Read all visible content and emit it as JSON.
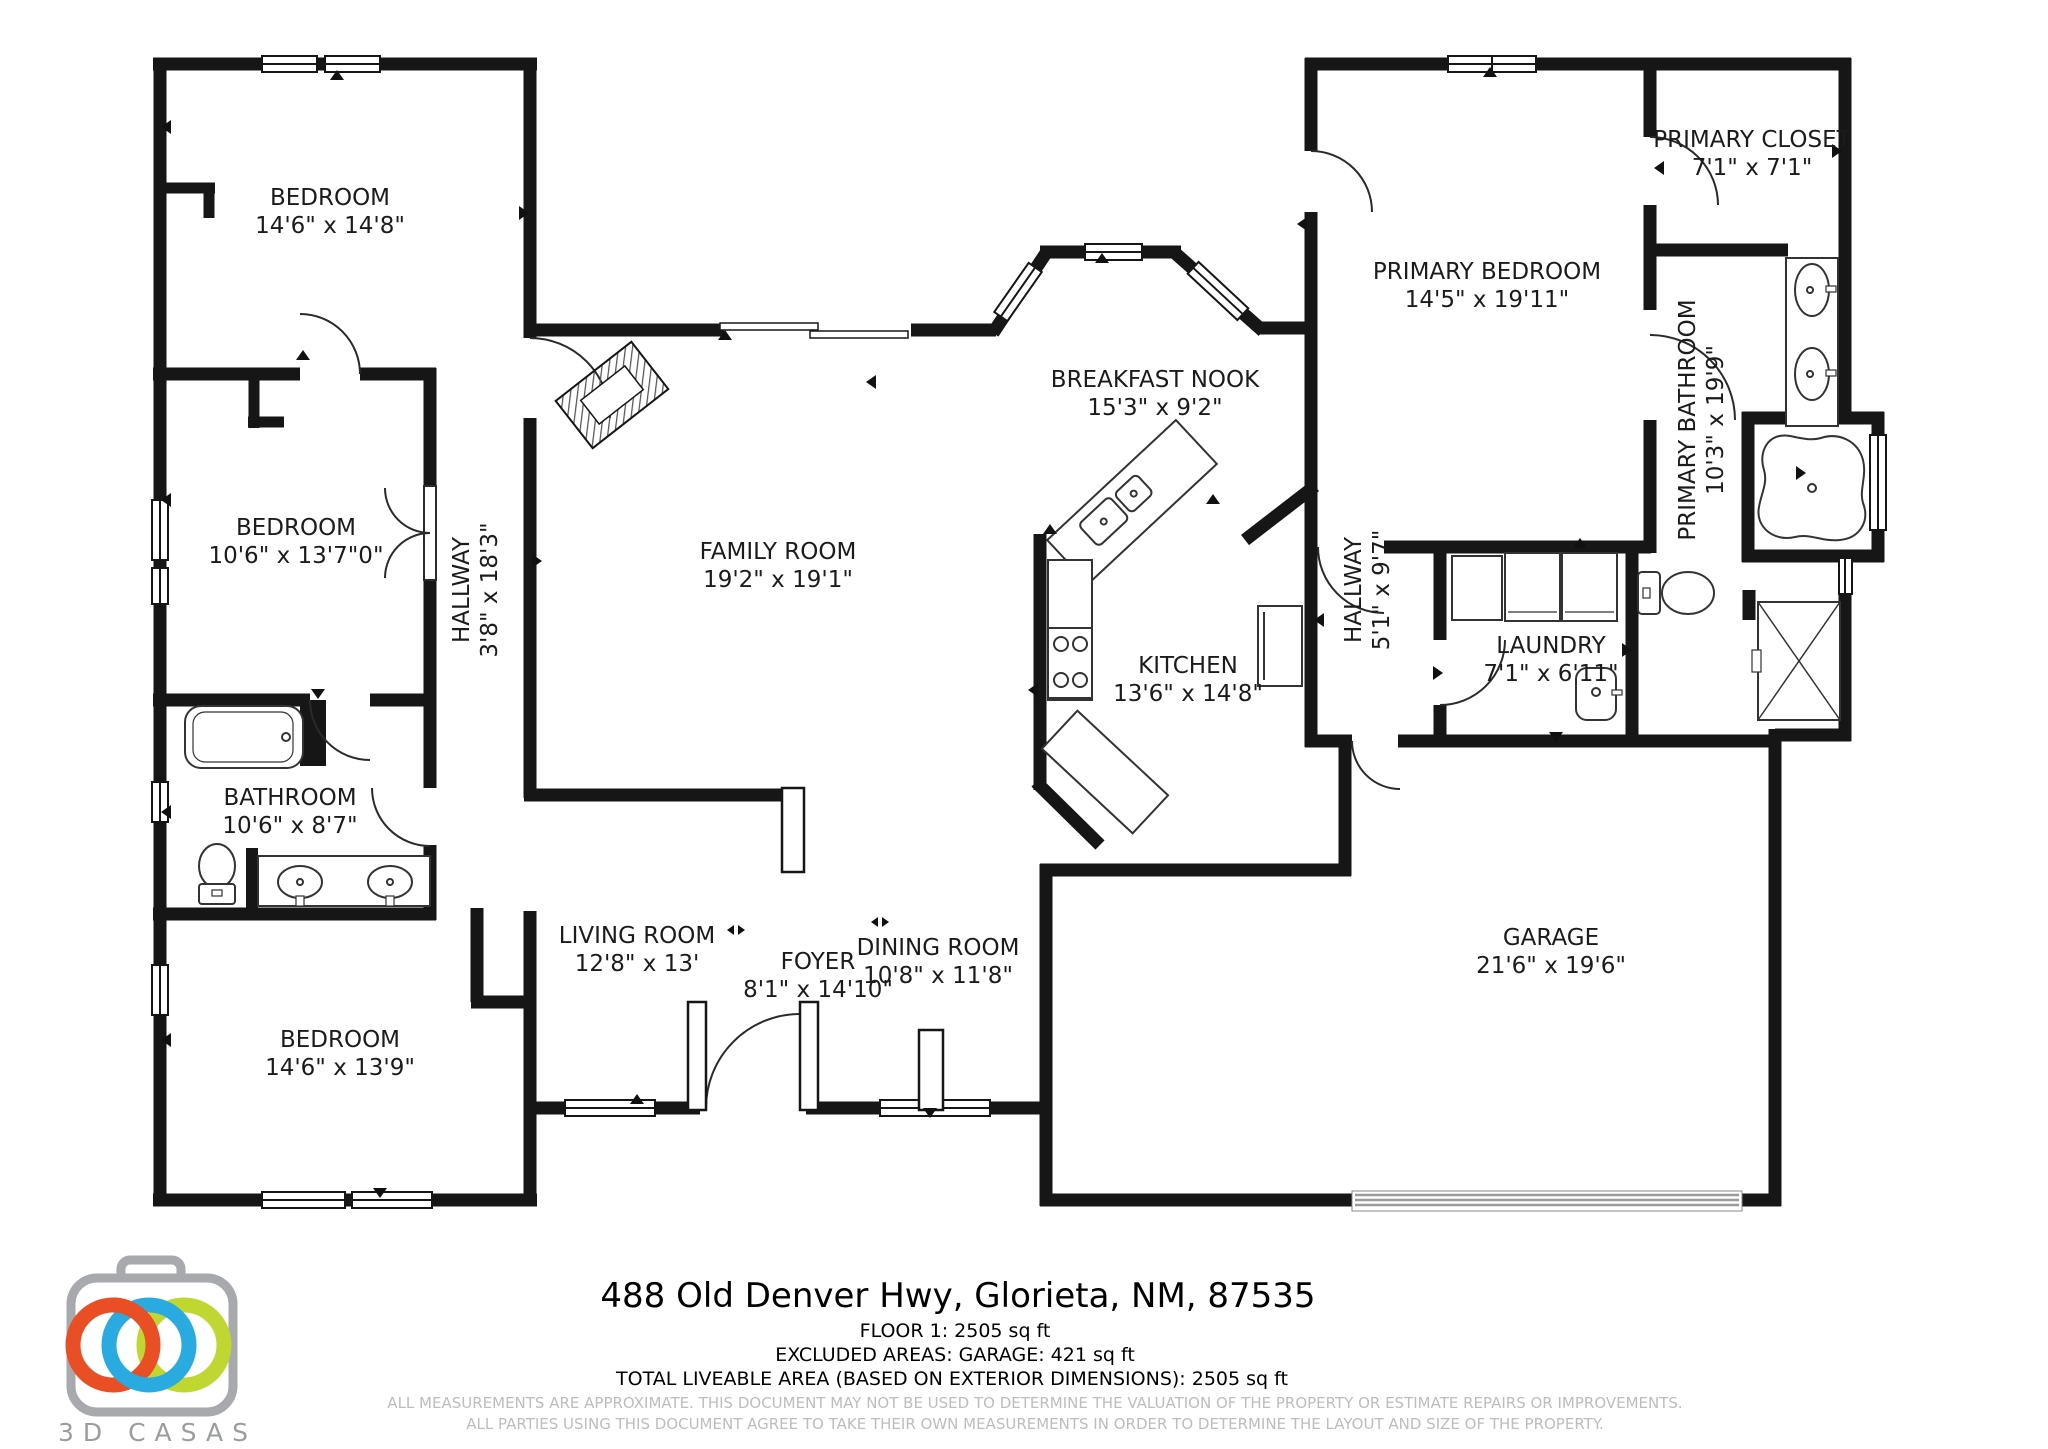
{
  "address": "488 Old Denver Hwy, Glorieta, NM, 87535",
  "floor_summary": {
    "floor_line": "FLOOR 1: 2505 sq ft",
    "excluded_line": "EXCLUDED AREAS: GARAGE: 421 sq ft",
    "total_line": "TOTAL LIVEABLE AREA (BASED ON EXTERIOR DIMENSIONS): 2505 sq ft"
  },
  "disclaimer": {
    "line1": "ALL MEASUREMENTS ARE APPROXIMATE. THIS DOCUMENT MAY NOT BE USED TO DETERMINE THE VALUATION OF THE PROPERTY OR ESTIMATE REPAIRS OR IMPROVEMENTS.",
    "line2": "ALL PARTIES USING THIS DOCUMENT AGREE TO TAKE THEIR OWN MEASUREMENTS IN ORDER TO DETERMINE THE LAYOUT AND SIZE OF THE PROPERTY."
  },
  "logo": {
    "brand": "3D CASAS",
    "orange": "#E94E24",
    "blue": "#29ABE2",
    "green": "#BFD730",
    "gray": "#A7A9AC"
  },
  "rooms": [
    {
      "id": "bedroom-1",
      "label": "BEDROOM",
      "dims": "14'6\" x 14'8\"",
      "cx": 330,
      "cy": 212,
      "rotate": 0
    },
    {
      "id": "bedroom-2",
      "label": "BEDROOM",
      "dims": "10'6\" x 13'7\"0\"",
      "cx": 296,
      "cy": 542,
      "rotate": 0
    },
    {
      "id": "hallway-main",
      "label": "HALLWAY",
      "dims": "3'8\" x 18'3\"",
      "cx": 476,
      "cy": 590,
      "rotate": -90
    },
    {
      "id": "bathroom",
      "label": "BATHROOM",
      "dims": "10'6\" x 8'7\"",
      "cx": 290,
      "cy": 812,
      "rotate": 0
    },
    {
      "id": "bedroom-3",
      "label": "BEDROOM",
      "dims": "14'6\" x 13'9\"",
      "cx": 340,
      "cy": 1054,
      "rotate": 0
    },
    {
      "id": "family-room",
      "label": "FAMILY ROOM",
      "dims": "19'2\" x 19'1\"",
      "cx": 778,
      "cy": 566,
      "rotate": 0
    },
    {
      "id": "living-room",
      "label": "LIVING ROOM",
      "dims": "12'8\" x 13'",
      "cx": 637,
      "cy": 950,
      "rotate": 0
    },
    {
      "id": "foyer",
      "label": "FOYER",
      "dims": "8'1\" x 14'10\"",
      "cx": 818,
      "cy": 976,
      "rotate": 0
    },
    {
      "id": "dining-room",
      "label": "DINING ROOM",
      "dims": "10'8\" x 11'8\"",
      "cx": 938,
      "cy": 962,
      "rotate": 0
    },
    {
      "id": "breakfast-nook",
      "label": "BREAKFAST NOOK",
      "dims": "15'3\" x 9'2\"",
      "cx": 1155,
      "cy": 394,
      "rotate": 0
    },
    {
      "id": "kitchen",
      "label": "KITCHEN",
      "dims": "13'6\" x 14'8\"",
      "cx": 1188,
      "cy": 680,
      "rotate": 0
    },
    {
      "id": "hallway-rear",
      "label": "HALLWAY",
      "dims": "5'1\" x 9'7\"",
      "cx": 1368,
      "cy": 590,
      "rotate": -90
    },
    {
      "id": "laundry",
      "label": "LAUNDRY",
      "dims": "7'1\" x 6'11\"",
      "cx": 1551,
      "cy": 660,
      "rotate": 0
    },
    {
      "id": "primary-bedroom",
      "label": "PRIMARY BEDROOM",
      "dims": "14'5\" x 19'11\"",
      "cx": 1487,
      "cy": 286,
      "rotate": 0
    },
    {
      "id": "primary-closet",
      "label": "PRIMARY CLOSET",
      "dims": "7'1\" x 7'1\"",
      "cx": 1752,
      "cy": 154,
      "rotate": 0
    },
    {
      "id": "primary-bathroom",
      "label": "PRIMARY BATHROOM",
      "dims": "10'3\" x 19'9\"",
      "cx": 1702,
      "cy": 420,
      "rotate": -90
    },
    {
      "id": "garage",
      "label": "GARAGE",
      "dims": "21'6\" x 19'6\"",
      "cx": 1551,
      "cy": 952,
      "rotate": 0
    }
  ]
}
